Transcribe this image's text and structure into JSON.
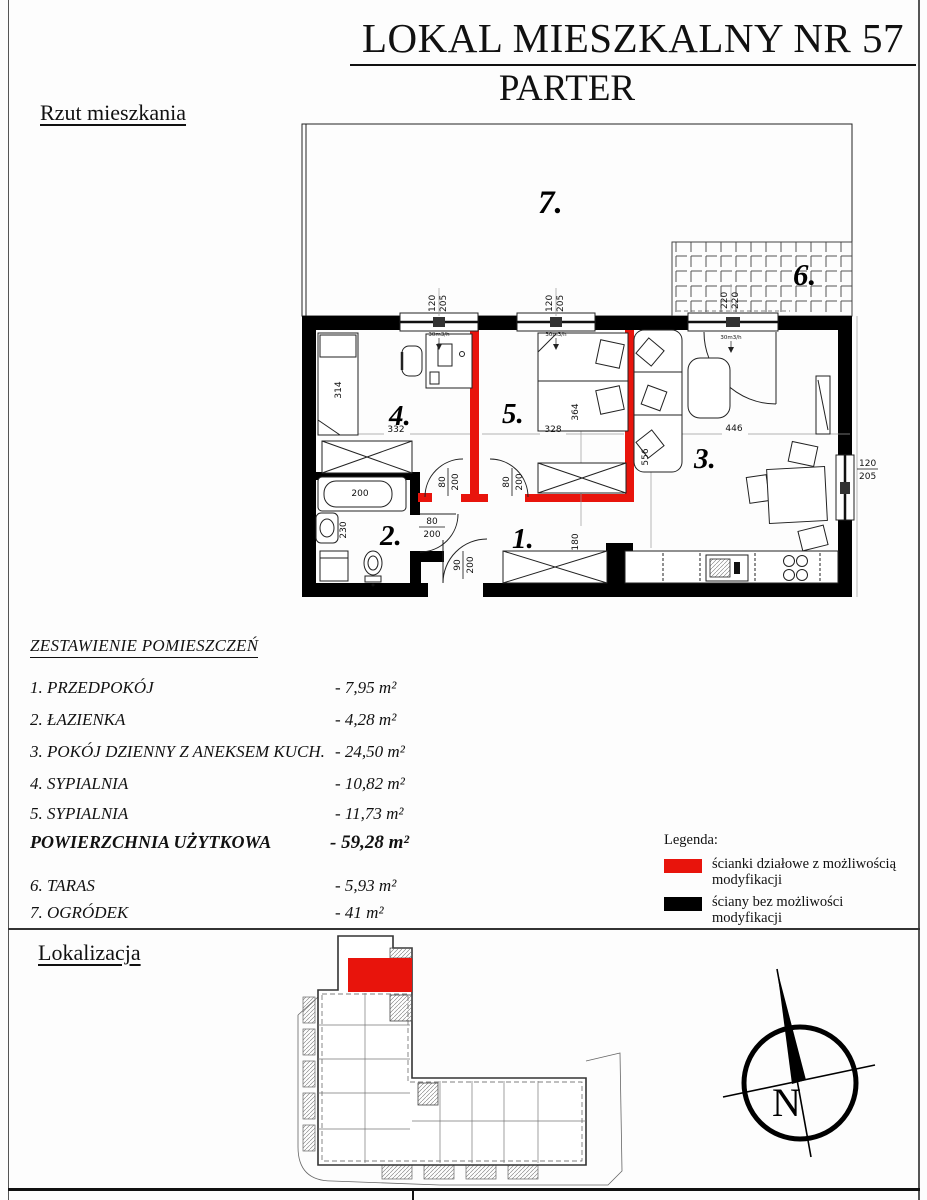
{
  "title": {
    "line1": "LOKAL MIESZKALNY NR 57",
    "line2": "PARTER"
  },
  "sections": {
    "plan": "Rzut mieszkania",
    "location": "Lokalizacja"
  },
  "room_table": {
    "heading": "ZESTAWIENIE POMIESZCZEŃ",
    "rows": [
      {
        "label": "1. PRZEDPOKÓJ",
        "area": "- 7,95 m²"
      },
      {
        "label": "2. ŁAZIENKA",
        "area": "- 4,28 m²"
      },
      {
        "label": "3. POKÓJ DZIENNY Z ANEKSEM KUCH.",
        "area": "- 24,50 m²"
      },
      {
        "label": "4. SYPIALNIA",
        "area": "- 10,82 m²"
      },
      {
        "label": "5. SYPIALNIA",
        "area": "- 11,73 m²"
      }
    ],
    "total": {
      "label": "POWIERZCHNIA UŻYTKOWA",
      "area": "- 59,28 m²"
    },
    "extra": [
      {
        "label": "6. TARAS",
        "area": "- 5,93 m²"
      },
      {
        "label": "7. OGRÓDEK",
        "area": "- 41 m²"
      }
    ]
  },
  "legend": {
    "heading": "Legenda:",
    "items": [
      {
        "color": "#e8140c",
        "label": "ścianki działowe z możliwością modyfikacji"
      },
      {
        "color": "#000000",
        "label": "ściany bez możliwości modyfikacji"
      }
    ]
  },
  "colors": {
    "partition_red": "#e8140c",
    "structural_black": "#000000"
  },
  "floorplan": {
    "room_numbers": [
      "1.",
      "2.",
      "3.",
      "4.",
      "5.",
      "6.",
      "7."
    ],
    "dims": {
      "window_w": "120",
      "window_h": "205",
      "terrace_door_w": "220",
      "terrace_door_h": "220",
      "vent": "30m3/h",
      "bed_room4": "314",
      "width_room4": "332",
      "bed_room5": "364",
      "width_room5": "328",
      "width_room3": "446",
      "depth_room3": "556",
      "hall_width": "180",
      "bathtub": "200",
      "bath_sink": "230",
      "door_w": "80",
      "door_h": "200",
      "entry_door_w": "90",
      "entry_door_h": "200"
    }
  },
  "compass": {
    "label": "N"
  }
}
